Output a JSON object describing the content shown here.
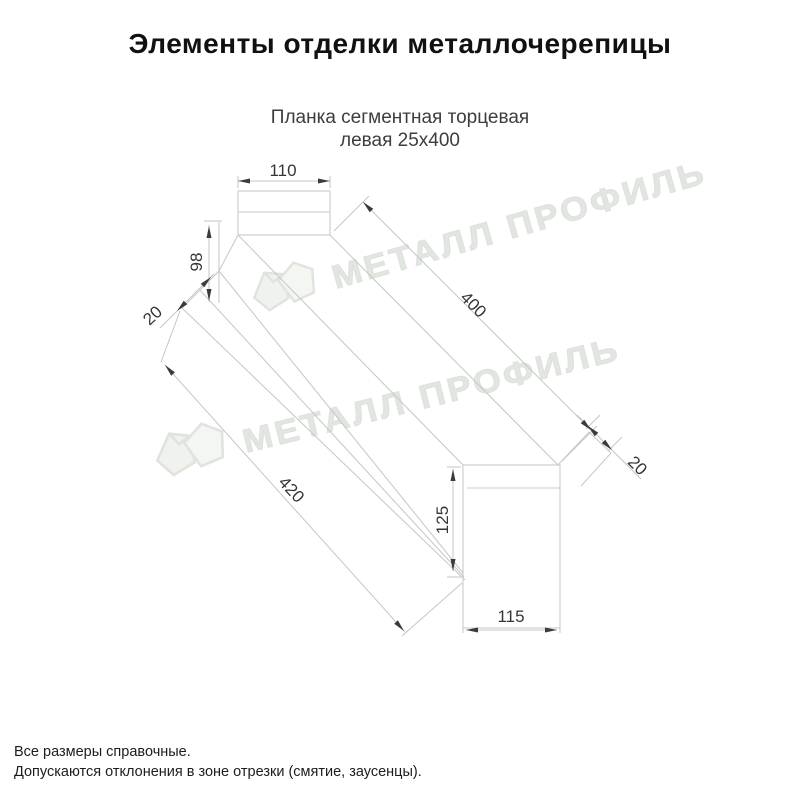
{
  "page": {
    "title": "Элементы отделки металлочерепицы",
    "subtitle_line1": "Планка сегментная торцевая",
    "subtitle_line2": "левая 25х400"
  },
  "drawing": {
    "type": "technical-line-drawing",
    "part_name": "Планка сегментная торцевая левая 25х400",
    "dimensions": {
      "top_width": "110",
      "left_height": "98",
      "left_flange": "20",
      "top_length": "400",
      "bottom_length": "420",
      "end_flange": "20",
      "end_height": "125",
      "end_width": "115"
    },
    "line_color": "#c7ccc6",
    "dim_text_color": "#353535"
  },
  "watermark": {
    "text": "МЕТАЛЛ ПРОФИЛЬ",
    "color": "#e2e6e1"
  },
  "footer": {
    "line1": "Все размеры справочные.",
    "line2": "Допускаются отклонения в зоне отрезки (смятие, заусенцы)."
  }
}
